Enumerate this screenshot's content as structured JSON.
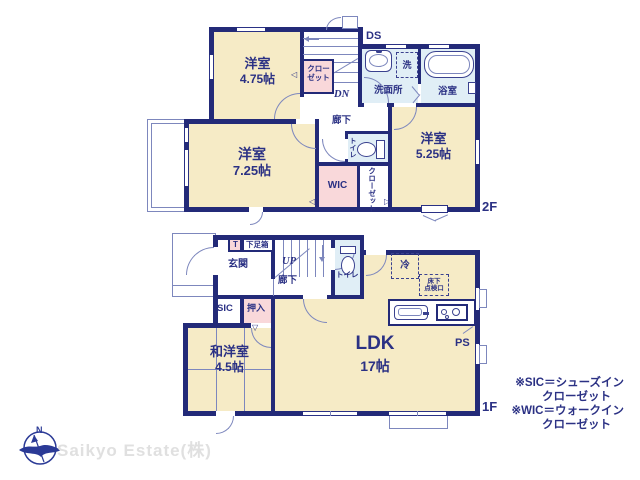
{
  "colors": {
    "wall": "#232a78",
    "room_cream": "#f6ebc6",
    "room_pink": "#f9d8da",
    "room_blue": "#e0eef6",
    "thin_line": "#7d87bd",
    "text": "#2b3184",
    "watermark": "#e0e0e0"
  },
  "floor2": {
    "label": "2F",
    "rooms": {
      "bedroom_475": {
        "name": "洋室",
        "size": "4.75帖"
      },
      "bedroom_725": {
        "name": "洋室",
        "size": "7.25帖"
      },
      "bedroom_525": {
        "name": "洋室",
        "size": "5.25帖"
      },
      "closet_stairs_l1": "クロー",
      "closet_stairs_l2": "ゼット",
      "closet_vertical": "クローゼット",
      "wic": "WIC",
      "washroom": "洗面所",
      "washer": "洗",
      "bathroom": "浴室",
      "toilet": "トイレ",
      "hallway": "廊下",
      "dn": "DN",
      "ds": "DS"
    }
  },
  "floor1": {
    "label": "1F",
    "rooms": {
      "genkan": "玄関",
      "t_box": "T",
      "shoe_box": "下足箱",
      "up": "UP",
      "hallway": "廊下",
      "toilet": "トイレ",
      "sic": "SIC",
      "oshiire": "押入",
      "tatami_room": {
        "name": "和洋室",
        "size": "4.5帖"
      },
      "ldk": {
        "name": "LDK",
        "size": "17帖"
      },
      "fridge": "冷",
      "hatch_l1": "床下",
      "hatch_l2": "点検口",
      "ps": "PS"
    }
  },
  "legend": {
    "l1": "※SIC＝シューズイン",
    "l2": "クローゼット",
    "l3": "※WIC＝ウォークイン",
    "l4": "クローゼット"
  },
  "branding": {
    "company": "Saikyo Estate(株)",
    "compass_n": "N"
  },
  "icons": {
    "tri_left": "◁",
    "tri_right": "▷",
    "tri_down": "▽"
  }
}
